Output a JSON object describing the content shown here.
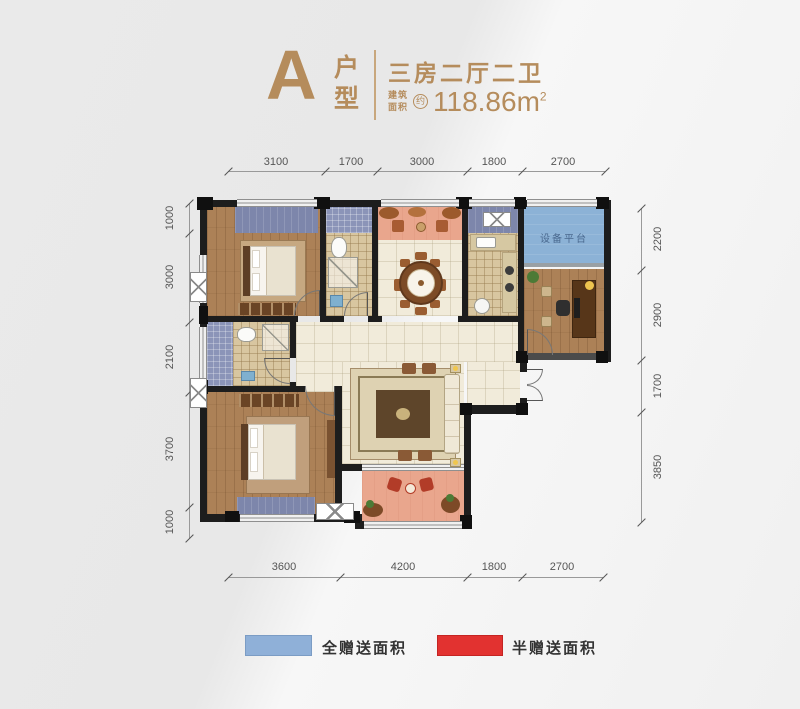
{
  "header": {
    "type_letter": "A",
    "type_label": "户型",
    "layout_title": "三房二厅二卫",
    "area_label_line1": "建筑",
    "area_label_line2": "面积",
    "area_approx": "约",
    "area_value": "118.86m",
    "area_superscript": "2"
  },
  "dimensions": {
    "top": [
      "3100",
      "1700",
      "3000",
      "1800",
      "2700"
    ],
    "bottom": [
      "3600",
      "4200",
      "1800",
      "2700"
    ],
    "left": [
      "1000",
      "3000",
      "2100",
      "3700",
      "1000"
    ],
    "right": [
      "2200",
      "2900",
      "1700",
      "3850"
    ]
  },
  "plan": {
    "labels": {
      "equipment_platform": "设备平台"
    },
    "icons": {
      "ac_unit": "boxed-x envelope symbol"
    }
  },
  "legend": {
    "items": [
      {
        "swatch_color": "#8fb0d8",
        "label": "全赠送面积"
      },
      {
        "swatch_color": "#e23230",
        "label": "半赠送面积"
      }
    ]
  },
  "colors": {
    "accent_gold": "#b58c5c",
    "gift_full_blue": "#8fb0d8",
    "gift_half_red": "#e23230",
    "balcony_pink": "#e9a68d",
    "bay_blue": "#7d86ab",
    "platform_blue": "#8cb2d6",
    "wall_black": "#1d1d1d",
    "wood_floor": "#ac8157"
  }
}
